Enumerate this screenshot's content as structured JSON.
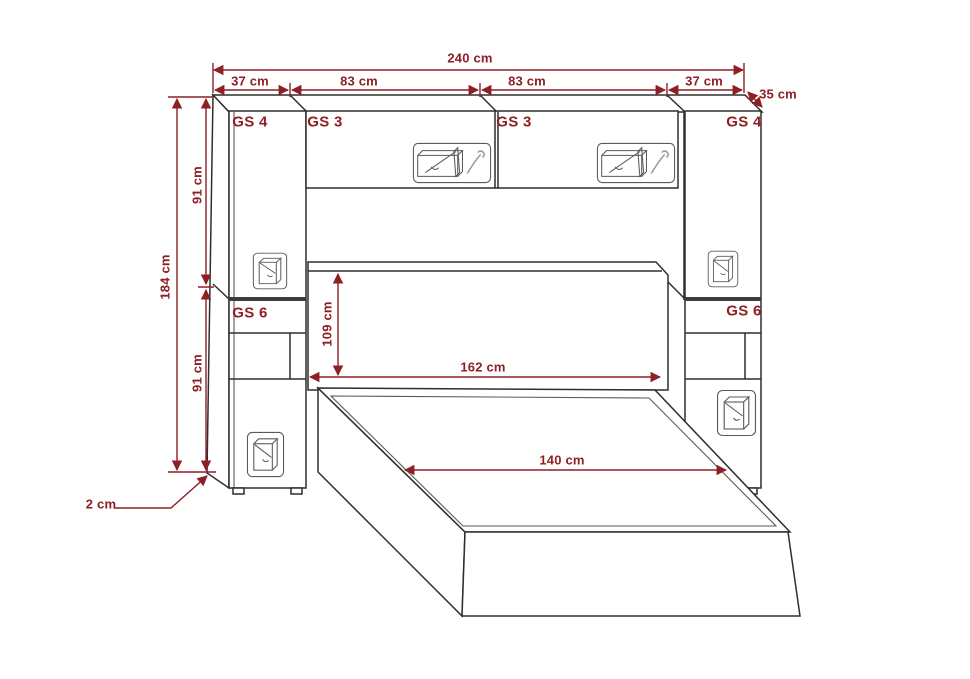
{
  "colors": {
    "accent": "#8e1f24",
    "line": "#2e2e2e",
    "background": "#ffffff"
  },
  "dims": {
    "total_width": "240 cm",
    "left_side_width": "37 cm",
    "left_center_width": "83 cm",
    "right_center_width": "83 cm",
    "right_side_width": "37 cm",
    "depth": "35 cm",
    "total_height": "184 cm",
    "upper_section_height": "91 cm",
    "lower_section_height": "91 cm",
    "headboard_height": "109 cm",
    "headboard_width": "162 cm",
    "bed_width": "140 cm",
    "plinth_height": "2 cm"
  },
  "units": {
    "left_upper_cabinet": "GS 4",
    "left_bridge_cabinet": "GS 3",
    "right_bridge_cabinet": "GS 3",
    "right_upper_cabinet": "GS 4",
    "left_lower_cabinet": "GS 6",
    "right_lower_cabinet": "GS 6"
  },
  "icons": {
    "door": "open-door-icon",
    "flap": "lift-up-flap-icon"
  }
}
